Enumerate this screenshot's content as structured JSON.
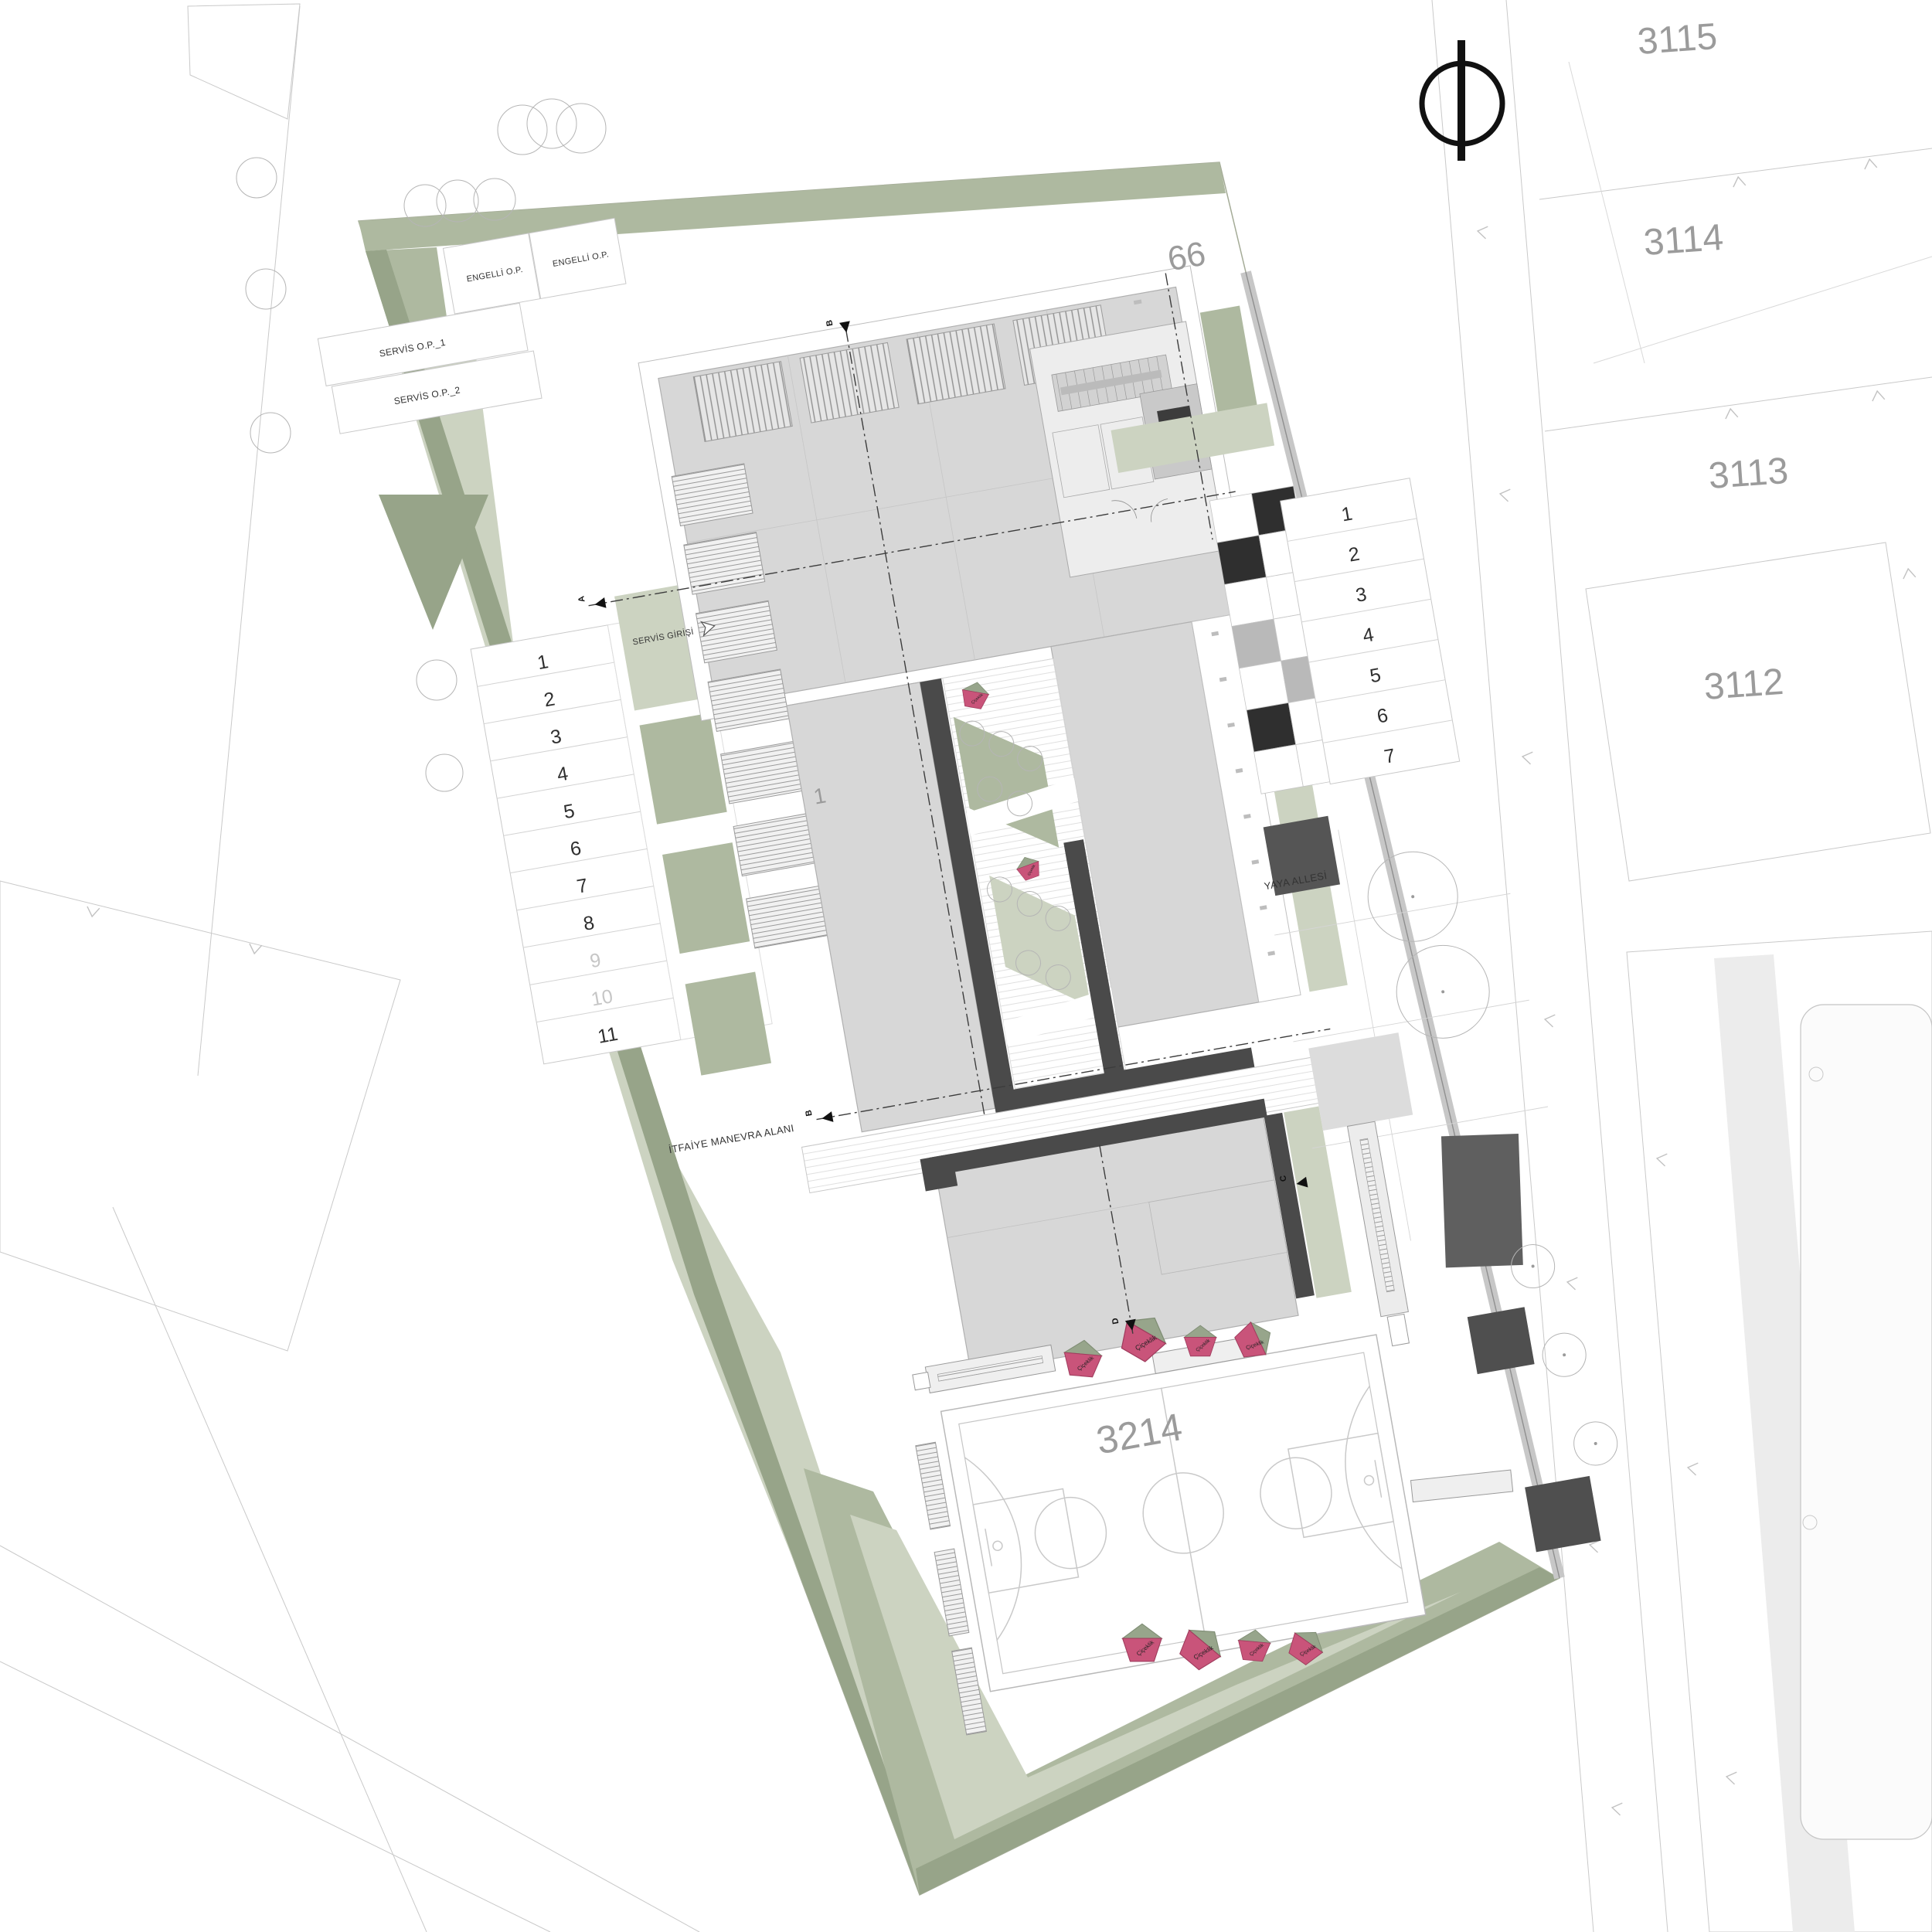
{
  "site": {
    "parcel_label": "3214",
    "block_label": "66",
    "building_label": "1"
  },
  "neighbor_parcels": {
    "p1": "3115",
    "p2": "3114",
    "p3": "3113",
    "p4": "3112"
  },
  "parking": {
    "left": [
      "1",
      "2",
      "3",
      "4",
      "5",
      "6",
      "7",
      "8",
      "9",
      "10",
      "11"
    ],
    "right": [
      "1",
      "2",
      "3",
      "4",
      "5",
      "6",
      "7"
    ]
  },
  "stalls": {
    "accessible": "ENGELLİ O.P.",
    "service_1": "SERVİS O.P._1",
    "service_2": "SERVİS O.P._2"
  },
  "annotations": {
    "pedestrian_alley": "YAYA ALLESİ",
    "fire_lane": "İTFAİYE MANEVRA ALANI",
    "service_entrance": "SERVİS GİRİŞİ",
    "flower_bed": "Çiçeklik"
  },
  "section_markers": {
    "a": "A",
    "b": "B",
    "c": "C",
    "d": "D"
  },
  "colors": {
    "sage": "#aeb9a0",
    "sage_light": "#ccd3c1",
    "sage_dark": "#97a489",
    "roof_gray": "#d7d7d7",
    "wall_dark": "#4a4a4a",
    "accent_pink": "#c9547a",
    "label_gray": "#9b9b9b"
  }
}
